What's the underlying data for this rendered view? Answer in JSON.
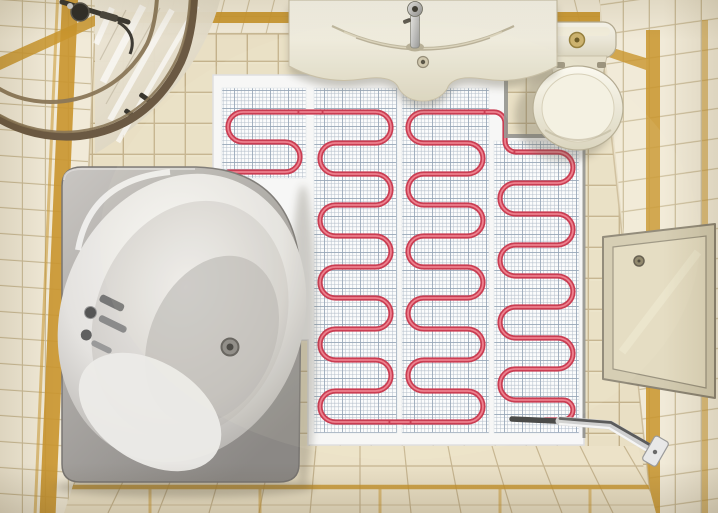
{
  "meta": {
    "type": "photo",
    "subject": "Top-down view of a small bathroom with an electric underfloor heating cable mat laid on the open floor area before tiling",
    "room": "bathroom"
  },
  "palette": {
    "wall_tile": "#f1ead8",
    "wall_grout": "#c9ba97",
    "floor_tile": "#e9dfc4",
    "floor_grout": "#c3b18b",
    "fan_tile": "#ece2c8",
    "gold": "#c9952d",
    "screed": "#f7f7f8",
    "mesh_bg": "#fbfcfe",
    "mesh_line": "#aab6c6",
    "mesh_line_strong": "#8fa0b4",
    "cable": "#c62f47",
    "cable_highlight": "#f0808f",
    "cold_lead": "#3e3e3e",
    "trim": "#8f8f8c",
    "rail": "#6b5943",
    "rail_highlight": "#8a7758",
    "chrome": "#d0d0d0",
    "panel": "#e3dbc1",
    "panel_frame": "#d3cbb1"
  },
  "objects": [
    {
      "name": "corner-bathtub",
      "position": "left",
      "color": "white-grey acrylic"
    },
    {
      "name": "shower-enclosure",
      "position": "top-left",
      "detail": "quarter-round bronze rail with glass doors and shower head"
    },
    {
      "name": "vanity-sink",
      "position": "top-center",
      "detail": "cream counter with chrome faucet and crescent basin"
    },
    {
      "name": "toilet",
      "position": "top-right",
      "detail": "ivory tank with gold flush button, closed oval lid"
    },
    {
      "name": "underfloor-heating-mat",
      "position": "center floor",
      "detail": "4 white mesh strips with red serpentine heating cable"
    },
    {
      "name": "cold-lead-conduit",
      "position": "bottom-right",
      "detail": "dark lead from mat into chrome conduit to wall plate"
    },
    {
      "name": "access-panel",
      "position": "right wall",
      "detail": "beige hatch with small knob"
    },
    {
      "name": "gold-accent-stripes",
      "position": "walls and floor",
      "detail": "amber tile accent bands"
    },
    {
      "name": "stepped-tile-edge",
      "position": "between bathtub and mat",
      "detail": "staircase-shaped old tile boundary"
    }
  ],
  "heating_mat": {
    "strips": 4,
    "cable_color_name": "red",
    "columns": [
      {
        "id": "strip-1",
        "x0": 222,
        "x1": 306,
        "y_top": 88,
        "y_bottom": 178,
        "runs_y": [
          112,
          142,
          172
        ],
        "first_dir": "L"
      },
      {
        "id": "strip-2",
        "x0": 314,
        "x1": 397,
        "y_top": 88,
        "y_bottom": 433,
        "runs_y": [
          112,
          143,
          174,
          205,
          236,
          267,
          298,
          329,
          360,
          391,
          422
        ],
        "first_dir": "R"
      },
      {
        "id": "strip-3",
        "x0": 402,
        "x1": 489,
        "y_top": 88,
        "y_bottom": 433,
        "runs_y": [
          112,
          143,
          174,
          205,
          236,
          267,
          298,
          329,
          360,
          391,
          422
        ],
        "first_dir": "L"
      },
      {
        "id": "strip-4",
        "x0": 494,
        "x1": 579,
        "y_top": 141,
        "y_bottom": 433,
        "runs_y": [
          152,
          183,
          214,
          245,
          276,
          307,
          338,
          369,
          400
        ],
        "first_dir": "R",
        "start_x": 516,
        "tail": {
          "r": 10,
          "end_x": 545
        }
      }
    ],
    "links": [
      [
        [
          300,
          112
        ],
        [
          321,
          112
        ]
      ],
      [
        [
          391,
          422
        ],
        [
          409,
          422
        ]
      ]
    ],
    "connector_path": "M 483,112 H 494 A 11 11 0 0 1 505,123 V 141 A 11 11 0 0 0 516,152",
    "cold_lead": {
      "x1": 512,
      "y1": 419,
      "x2": 598,
      "y2": 423
    }
  }
}
